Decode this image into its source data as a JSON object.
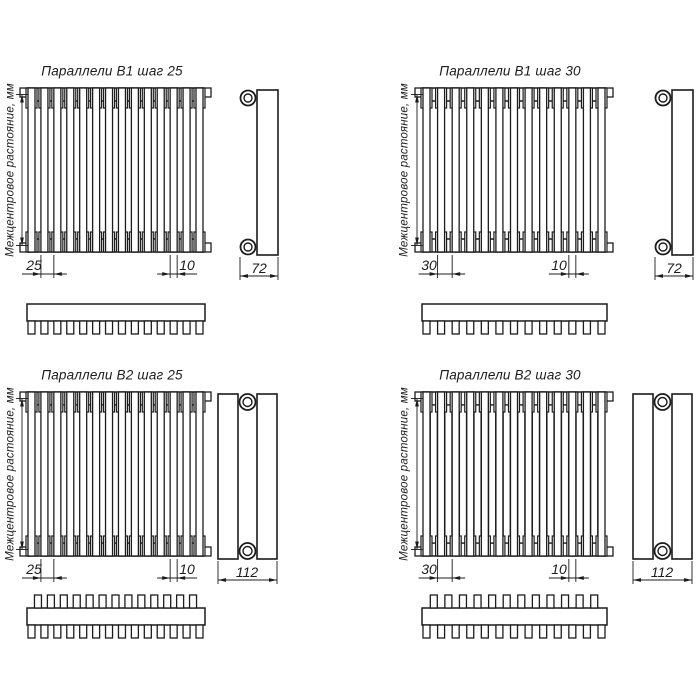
{
  "canvas": {
    "width": 700,
    "height": 700,
    "background": "#ffffff",
    "line_color": "#1c1c1c"
  },
  "drawings": [
    {
      "id": "parallels-b1-step-25",
      "title": "Параллели В1 шаг 25",
      "vertical_label": "Межцентровое растояние, мм",
      "dimensions": {
        "step": "25",
        "tube_width": "10",
        "depth": "72"
      },
      "geometry": {
        "front_x": 28,
        "front_y": 88,
        "front_w": 175,
        "front_h": 164,
        "tubes": 14,
        "double_row": false,
        "side_x": 257,
        "side_style": "single",
        "tube_dim_text": "right"
      }
    },
    {
      "id": "parallels-b1-step-30",
      "title": "Параллели В1 шаг 30",
      "vertical_label": "Межцентровое растояние, мм",
      "dimensions": {
        "step": "30",
        "tube_width": "10",
        "depth": "72"
      },
      "geometry": {
        "front_x": 423,
        "front_y": 88,
        "front_w": 182,
        "front_h": 164,
        "tubes": 13,
        "double_row": false,
        "side_x": 672,
        "side_style": "single",
        "tube_dim_text": "left"
      }
    },
    {
      "id": "parallels-b2-step-25",
      "title": "Параллели В2 шаг 25",
      "vertical_label": "Межцентровое растояние, мм",
      "dimensions": {
        "step": "25",
        "tube_width": "10",
        "depth": "112"
      },
      "geometry": {
        "front_x": 28,
        "front_y": 392,
        "front_w": 175,
        "front_h": 164,
        "tubes": 14,
        "double_row": true,
        "side_x": 218,
        "side_style": "double",
        "tube_dim_text": "right"
      }
    },
    {
      "id": "parallels-b2-step-30",
      "title": "Параллели В2 шаг 30",
      "vertical_label": "Межцентровое растояние, мм",
      "dimensions": {
        "step": "30",
        "tube_width": "10",
        "depth": "112"
      },
      "geometry": {
        "front_x": 423,
        "front_y": 392,
        "front_w": 182,
        "front_h": 164,
        "tubes": 13,
        "double_row": true,
        "side_x": 633,
        "side_style": "double",
        "tube_dim_text": "left"
      }
    }
  ]
}
